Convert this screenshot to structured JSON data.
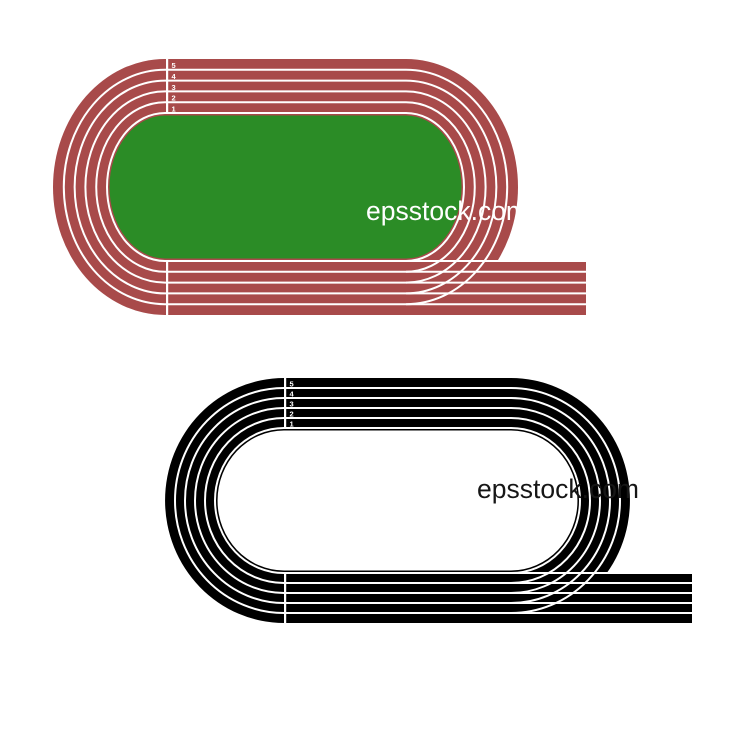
{
  "page": {
    "background_color": "#ffffff"
  },
  "illustrations": [
    {
      "name": "red-running-track",
      "kind": "running track top view, 5 lanes with exit straight",
      "lane_numbers": [
        "5",
        "4",
        "3",
        "2",
        "1"
      ],
      "watermark": "epsstock.com",
      "colors": {
        "track": "#a84a4a",
        "infield": "#2b8c26",
        "lane_line": "#ffffff",
        "number": "#ffffff",
        "watermark": "#ffffff"
      }
    },
    {
      "name": "black-running-track",
      "kind": "running track top view, 5 lanes with exit straight",
      "lane_numbers": [
        "5",
        "4",
        "3",
        "2",
        "1"
      ],
      "watermark": "epsstock.com",
      "colors": {
        "track": "#000000",
        "infield": "#ffffff",
        "lane_line": "#ffffff",
        "number": "#ffffff",
        "watermark": "#161616"
      }
    }
  ]
}
